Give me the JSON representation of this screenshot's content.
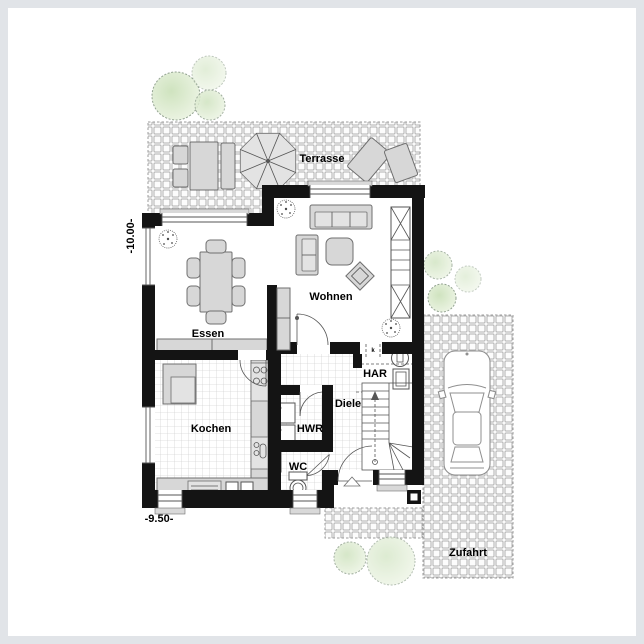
{
  "labels": {
    "terrasse": "Terrasse",
    "wohnen": "Wohnen",
    "essen": "Essen",
    "kochen": "Kochen",
    "diele": "Diele",
    "hwr": "HWR",
    "wc": "WC",
    "har": "HAR",
    "zufahrt": "Zufahrt"
  },
  "dimensions": {
    "left": "-10.00-",
    "bottom": "-9.50-"
  },
  "annotations": {
    "har_marker": "k"
  },
  "colors": {
    "wall": "#141414",
    "furn_fill": "#d7d7d7",
    "furn_stroke": "#6f6f6f",
    "furn_light": "#e3e3e3",
    "tile_line": "#c6c6c6",
    "paver_line": "#b0b0b0",
    "paver_bg": "#fcfcfc",
    "dash_border": "#9b9b9b",
    "tree_fill": "#d9e9cc",
    "tree_fill_light": "#ecf4e4",
    "tree_stroke": "#93a391",
    "outline": "#555555",
    "sill": "#d9d9d9",
    "text": "#000000",
    "frame": "#e1e4e8"
  }
}
